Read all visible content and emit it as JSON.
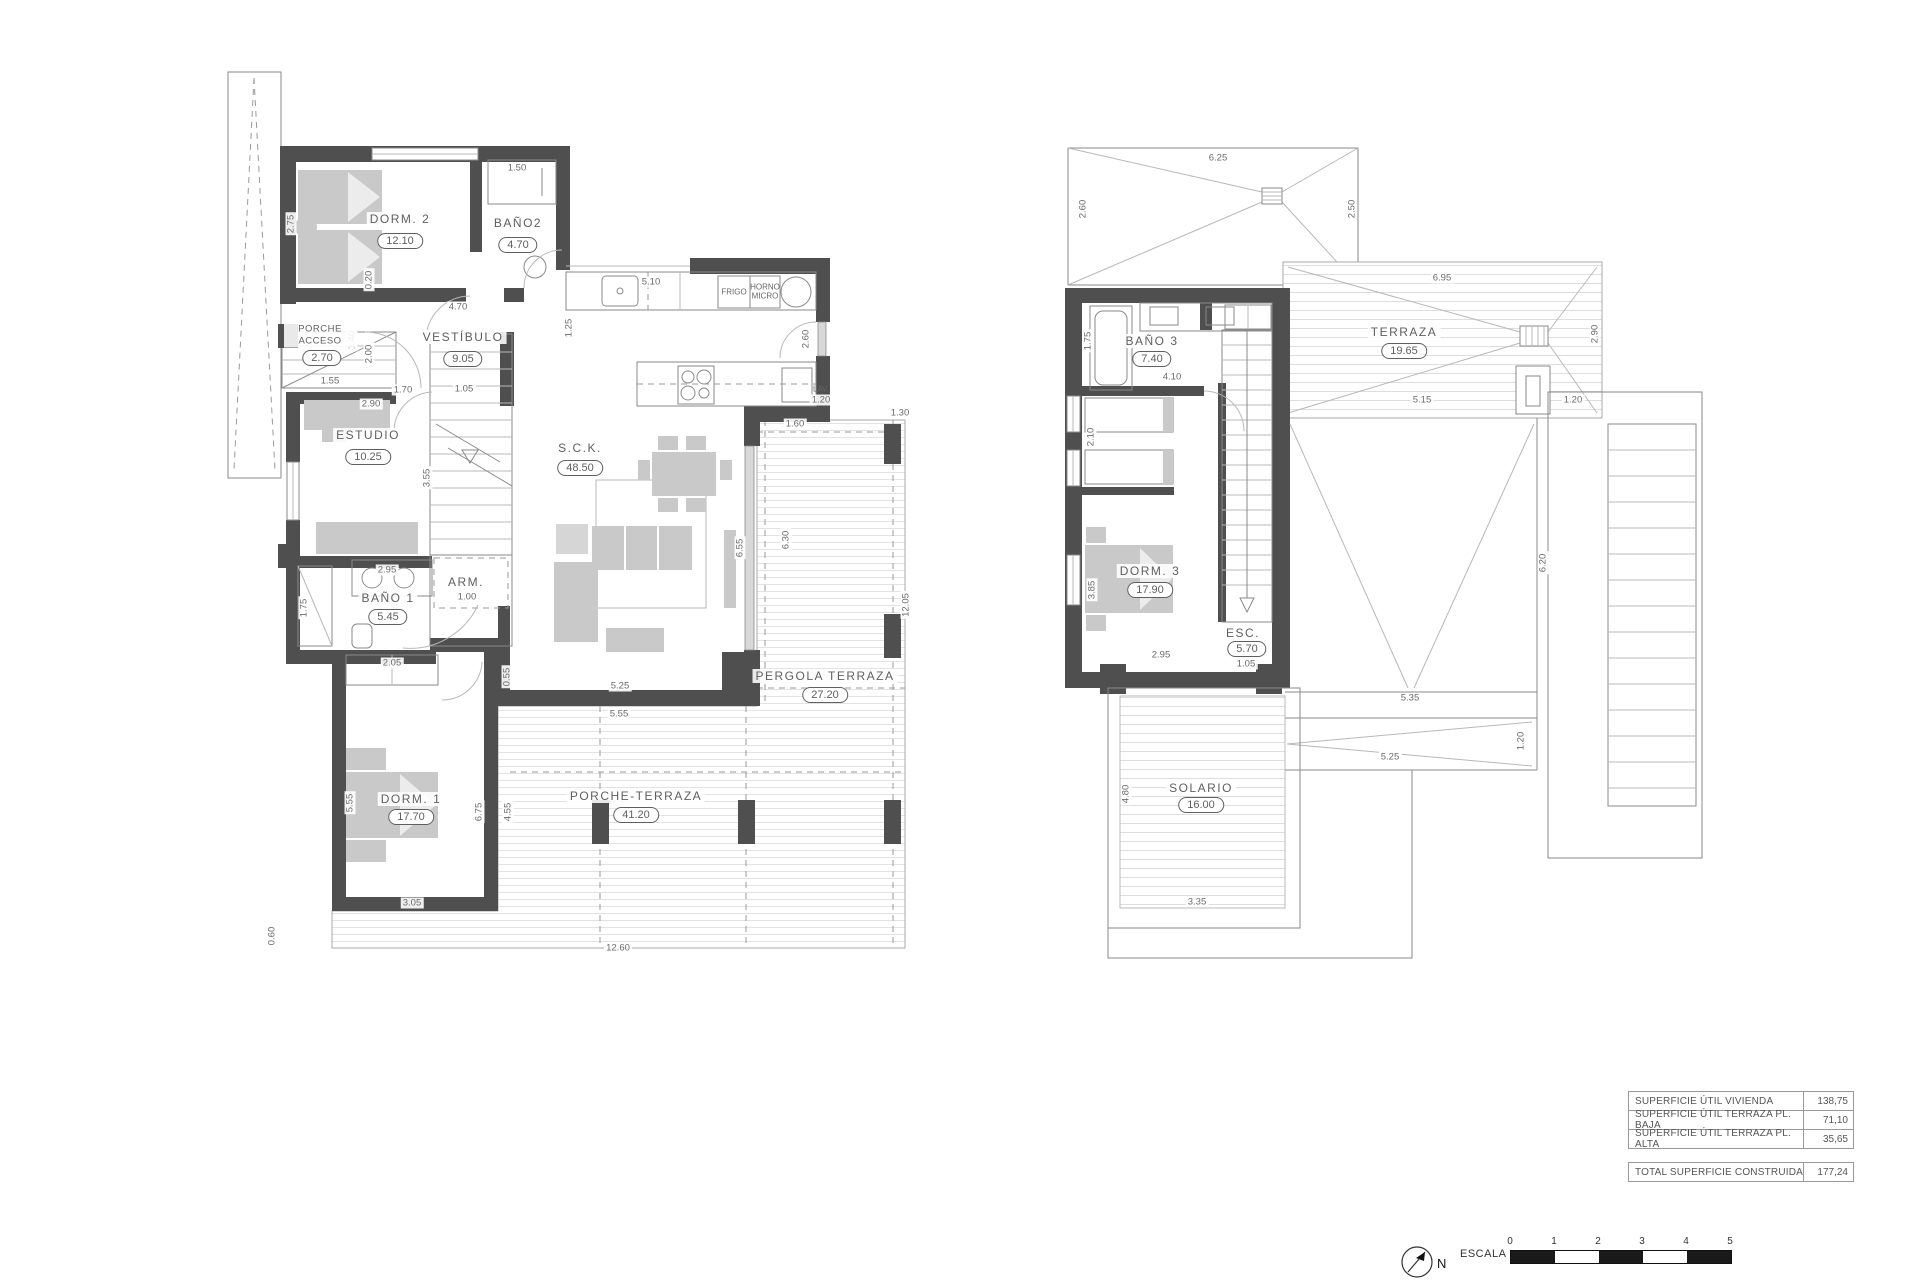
{
  "ground_floor": {
    "rooms": [
      {
        "name": "DORM. 2",
        "area": "12.10"
      },
      {
        "name": "BAÑO2",
        "area": "4.70"
      },
      {
        "name": "PORCHE ACCESO",
        "area": "2.70"
      },
      {
        "name": "VESTÍBULO",
        "area": "9.05"
      },
      {
        "name": "ESTUDIO",
        "area": "10.25"
      },
      {
        "name": "BAÑO 1",
        "area": "5.45"
      },
      {
        "name": "ARM.",
        "area": null
      },
      {
        "name": "S.C.K.",
        "area": "48.50"
      },
      {
        "name": "DORM. 1",
        "area": "17.70"
      },
      {
        "name": "PERGOLA TERRAZA",
        "area": "27.20"
      },
      {
        "name": "PORCHE-TERRAZA",
        "area": "41.20"
      }
    ],
    "labels": {
      "frigo": "FRIGO",
      "horno": "HORNO",
      "micro": "MICRO",
      "lav": "LAV."
    },
    "dims": [
      "1.50",
      "2.75",
      "0.20",
      "4.70",
      "5.10",
      "1.25",
      "2.60",
      "1.20",
      "1.30",
      "1.60",
      "1.55",
      "1.70",
      "2.00",
      "1.40",
      "1.05",
      "2.90",
      "3.55",
      "2.95",
      "1.75",
      "1.00",
      "2.05",
      "0.55",
      "5.55",
      "6.75",
      "4.55",
      "3.05",
      "0.60",
      "12.60",
      "12.05",
      "5.25",
      "5.55",
      "6.55",
      "6.30"
    ]
  },
  "upper_floor": {
    "rooms": [
      {
        "name": "BAÑO 3",
        "area": "7.40"
      },
      {
        "name": "TERRAZA",
        "area": "19.65"
      },
      {
        "name": "DORM. 3",
        "area": "17.90"
      },
      {
        "name": "ESC.",
        "area": "5.70"
      },
      {
        "name": "SOLARIO",
        "area": "16.00"
      }
    ],
    "dims": [
      "6.25",
      "2.60",
      "2.50",
      "6.95",
      "2.90",
      "5.15",
      "1.20",
      "1.75",
      "4.10",
      "2.10",
      "3.85",
      "2.95",
      "1.05",
      "6.20",
      "5.35",
      "5.25",
      "1.20",
      "4.80",
      "3.35"
    ]
  },
  "summary_table": {
    "rows": [
      {
        "label": "SUPERFICIE ÚTIL VIVIENDA",
        "value": "138,75"
      },
      {
        "label": "SUPERFICIE ÚTIL TERRAZA PL. BAJA",
        "value": "71,10"
      },
      {
        "label": "SUPERFICIE ÚTIL TERRAZA PL. ALTA",
        "value": "35,65"
      }
    ],
    "total": {
      "label": "TOTAL SUPERFICIE CONSTRUIDA",
      "value": "177,24"
    }
  },
  "scale_bar": {
    "label": "ESCALA :",
    "north": "N",
    "ticks": [
      "0",
      "1",
      "2",
      "3",
      "4",
      "5"
    ]
  }
}
